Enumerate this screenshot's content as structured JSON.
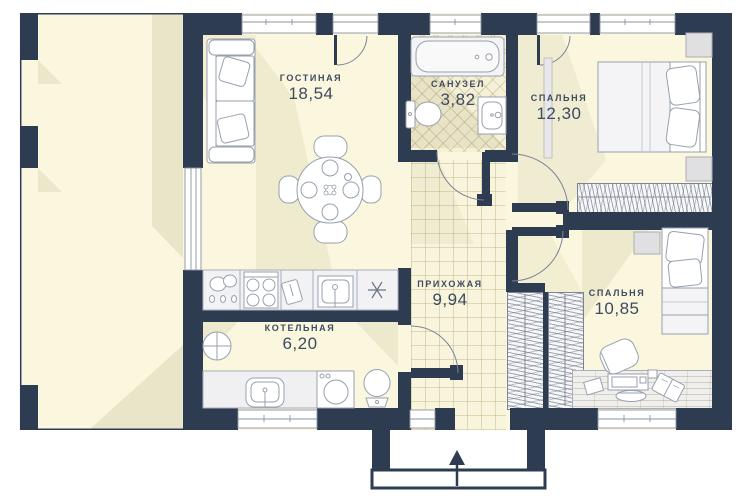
{
  "rooms": [
    {
      "id": "living",
      "name": "ГОСТИНАЯ",
      "area": "18,54"
    },
    {
      "id": "bathroom",
      "name": "САНУЗЕЛ",
      "area": "3,82"
    },
    {
      "id": "bedroom-1",
      "name": "СПАЛЬНЯ",
      "area": "12,30"
    },
    {
      "id": "hallway",
      "name": "ПРИХОЖАЯ",
      "area": "9,94"
    },
    {
      "id": "boiler",
      "name": "КОТЕЛЬНАЯ",
      "area": "6,20"
    },
    {
      "id": "bedroom-2",
      "name": "СПАЛЬНЯ",
      "area": "10,85"
    }
  ],
  "colors": {
    "wall": "#2e3c52",
    "floor": "#faf7de",
    "furniture_stroke": "#98a0ae",
    "label_text": "#3d4b60",
    "shadow": "#6d6426"
  },
  "icons": {
    "fridge_snowflake": "✳",
    "entrance_arrow": "▲"
  }
}
